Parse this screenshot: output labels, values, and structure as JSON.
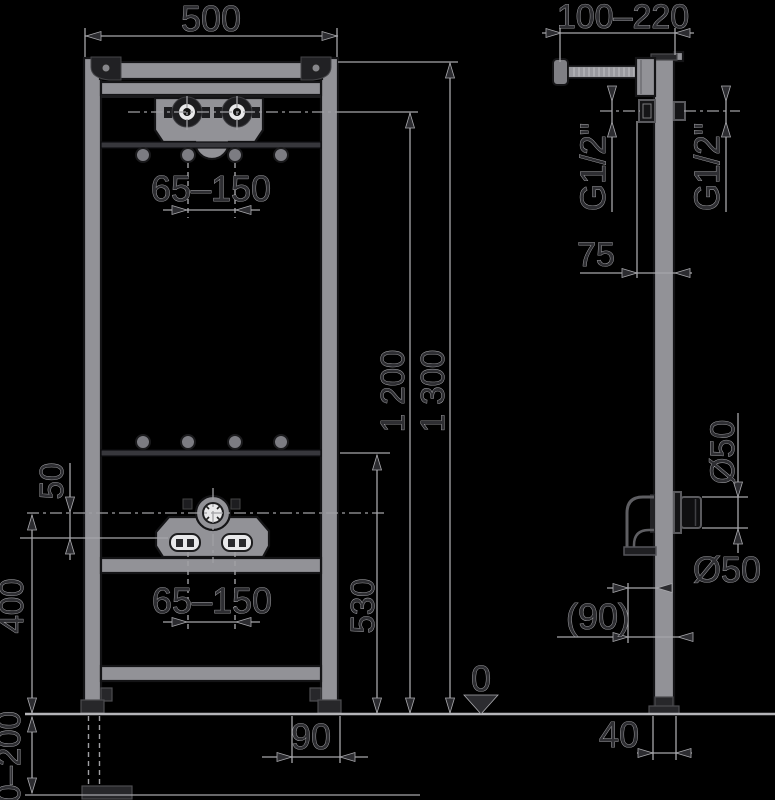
{
  "colors": {
    "background": "#000000",
    "metal": "#929297",
    "outline": "#141416",
    "dimension_lines": "#a6a6aa",
    "text": "#2e2e32",
    "white_detail": "#e9e9eb"
  },
  "front": {
    "width": "500",
    "upper_spacing": "65–150",
    "lower_spacing": "65–150",
    "height_1200": "1 200",
    "height_1300": "1 300",
    "height_530": "530",
    "height_400": "400",
    "offset_50": "50",
    "adjust_0_200": "0–200",
    "depth_90": "90"
  },
  "side": {
    "depth_100_220": "100–220",
    "thread_front": "G1/2\"",
    "thread_rear": "G1/2\"",
    "offset_75": "75",
    "dia_50_rotated": "Ø50",
    "dia_50": "Ø50",
    "offset_90_ref": "(90)",
    "depth_40": "40"
  },
  "datum": {
    "zero": "0"
  }
}
